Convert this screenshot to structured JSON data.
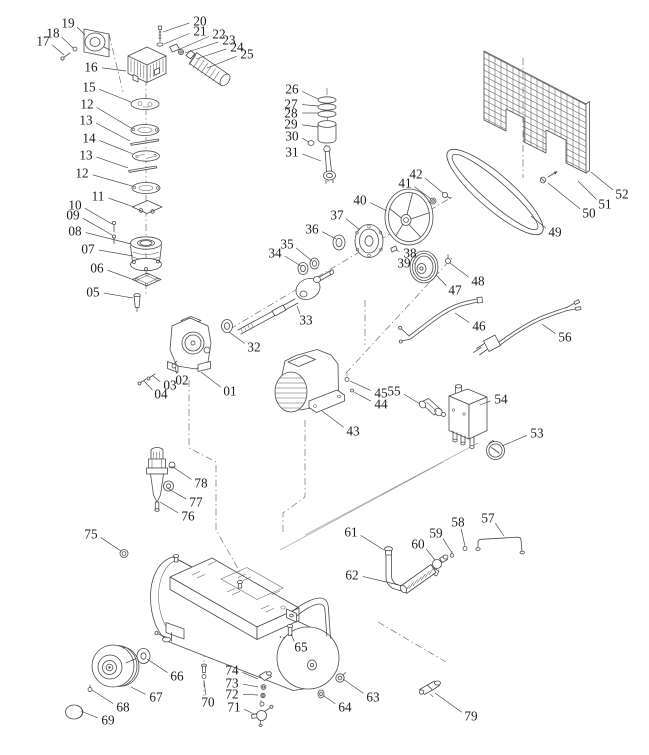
{
  "diagram": {
    "background": "#ffffff",
    "line_color": "#4a4a4a",
    "label_color": "#1b1b1b",
    "callouts": [
      {
        "label": "01",
        "x": 230,
        "y": 391,
        "tx": 201,
        "ty": 372
      },
      {
        "label": "02",
        "x": 182,
        "y": 380,
        "tx": 175,
        "ty": 367
      },
      {
        "label": "03",
        "x": 170,
        "y": 385,
        "tx": 153,
        "ty": 376
      },
      {
        "label": "04",
        "x": 161,
        "y": 394,
        "tx": 144,
        "ty": 381
      },
      {
        "label": "05",
        "x": 93,
        "y": 292,
        "tx": 133,
        "ty": 298
      },
      {
        "label": "06",
        "x": 97,
        "y": 268,
        "tx": 134,
        "ty": 280
      },
      {
        "label": "07",
        "x": 88,
        "y": 249,
        "tx": 133,
        "ty": 256
      },
      {
        "label": "08",
        "x": 75,
        "y": 231,
        "tx": 131,
        "ty": 244
      },
      {
        "label": "09",
        "x": 73,
        "y": 215,
        "tx": 112,
        "ty": 235
      },
      {
        "label": "10",
        "x": 75,
        "y": 205,
        "tx": 112,
        "ty": 224
      },
      {
        "label": "11",
        "x": 98,
        "y": 196,
        "tx": 134,
        "ty": 207
      },
      {
        "label": "12",
        "x": 87,
        "y": 104,
        "tx": 131,
        "ty": 128
      },
      {
        "label": "13",
        "x": 86,
        "y": 120,
        "tx": 130,
        "ty": 141
      },
      {
        "label": "14",
        "x": 89,
        "y": 138,
        "tx": 133,
        "ty": 154
      },
      {
        "label": "13",
        "x": 86,
        "y": 155,
        "tx": 128,
        "ty": 168
      },
      {
        "label": "12",
        "x": 82,
        "y": 173,
        "tx": 132,
        "ty": 186
      },
      {
        "label": "15",
        "x": 89,
        "y": 87,
        "tx": 131,
        "ty": 102
      },
      {
        "label": "16",
        "x": 91,
        "y": 67,
        "tx": 126,
        "ty": 71
      },
      {
        "label": "17",
        "x": 43,
        "y": 41,
        "tx": 64,
        "ty": 55
      },
      {
        "label": "18",
        "x": 53,
        "y": 33,
        "tx": 73,
        "ty": 48
      },
      {
        "label": "19",
        "x": 68,
        "y": 23,
        "tx": 85,
        "ty": 35
      },
      {
        "label": "20",
        "x": 200,
        "y": 21,
        "tx": 163,
        "ty": 32
      },
      {
        "label": "21",
        "x": 200,
        "y": 31,
        "tx": 164,
        "ty": 44
      },
      {
        "label": "22",
        "x": 219,
        "y": 34,
        "tx": 180,
        "ty": 49
      },
      {
        "label": "23",
        "x": 229,
        "y": 40,
        "tx": 185,
        "ty": 53
      },
      {
        "label": "24",
        "x": 237,
        "y": 47,
        "tx": 196,
        "ty": 59
      },
      {
        "label": "25",
        "x": 247,
        "y": 54,
        "tx": 207,
        "ty": 68
      },
      {
        "label": "26",
        "x": 292,
        "y": 89,
        "tx": 318,
        "ty": 99
      },
      {
        "label": "27",
        "x": 291,
        "y": 104,
        "tx": 318,
        "ty": 106
      },
      {
        "label": "28",
        "x": 291,
        "y": 113,
        "tx": 318,
        "ty": 113
      },
      {
        "label": "29",
        "x": 291,
        "y": 124,
        "tx": 318,
        "ty": 127
      },
      {
        "label": "30",
        "x": 292,
        "y": 136,
        "tx": 309,
        "ty": 142
      },
      {
        "label": "31",
        "x": 292,
        "y": 152,
        "tx": 321,
        "ty": 161
      },
      {
        "label": "32",
        "x": 254,
        "y": 347,
        "tx": 229,
        "ty": 332
      },
      {
        "label": "33",
        "x": 306,
        "y": 320,
        "tx": 297,
        "ty": 306
      },
      {
        "label": "34",
        "x": 275,
        "y": 253,
        "tx": 301,
        "ty": 266
      },
      {
        "label": "35",
        "x": 287,
        "y": 244,
        "tx": 312,
        "ty": 261
      },
      {
        "label": "36",
        "x": 312,
        "y": 229,
        "tx": 336,
        "ty": 239
      },
      {
        "label": "37",
        "x": 337,
        "y": 215,
        "tx": 360,
        "ty": 230
      },
      {
        "label": "38",
        "x": 410,
        "y": 253,
        "tx": 396,
        "ty": 250
      },
      {
        "label": "39",
        "x": 404,
        "y": 263,
        "tx": 414,
        "ty": 264
      },
      {
        "label": "40",
        "x": 360,
        "y": 200,
        "tx": 387,
        "ty": 211
      },
      {
        "label": "41",
        "x": 405,
        "y": 183,
        "tx": 431,
        "ty": 199
      },
      {
        "label": "42",
        "x": 416,
        "y": 174,
        "tx": 443,
        "ty": 193
      },
      {
        "label": "43",
        "x": 353,
        "y": 431,
        "tx": 322,
        "ty": 411
      },
      {
        "label": "44",
        "x": 381,
        "y": 404,
        "tx": 354,
        "ty": 392
      },
      {
        "label": "45",
        "x": 381,
        "y": 393,
        "tx": 350,
        "ty": 381
      },
      {
        "label": "46",
        "x": 479,
        "y": 326,
        "tx": 455,
        "ty": 313
      },
      {
        "label": "47",
        "x": 455,
        "y": 290,
        "tx": 436,
        "ty": 275
      },
      {
        "label": "48",
        "x": 478,
        "y": 281,
        "tx": 450,
        "ty": 263
      },
      {
        "label": "49",
        "x": 555,
        "y": 232,
        "tx": 531,
        "ty": 216
      },
      {
        "label": "50",
        "x": 589,
        "y": 213,
        "tx": 548,
        "ty": 183
      },
      {
        "label": "51",
        "x": 605,
        "y": 204,
        "tx": 578,
        "ty": 181
      },
      {
        "label": "52",
        "x": 622,
        "y": 194,
        "tx": 591,
        "ty": 172
      },
      {
        "label": "53",
        "x": 537,
        "y": 433,
        "tx": 502,
        "ty": 446
      },
      {
        "label": "54",
        "x": 501,
        "y": 399,
        "tx": 480,
        "ty": 405
      },
      {
        "label": "55",
        "x": 394,
        "y": 391,
        "tx": 420,
        "ty": 404
      },
      {
        "label": "56",
        "x": 565,
        "y": 337,
        "tx": 542,
        "ty": 324
      },
      {
        "label": "57",
        "x": 488,
        "y": 518,
        "tx": 504,
        "ty": 536
      },
      {
        "label": "58",
        "x": 458,
        "y": 522,
        "tx": 465,
        "ty": 546
      },
      {
        "label": "59",
        "x": 436,
        "y": 533,
        "tx": 452,
        "ty": 553
      },
      {
        "label": "60",
        "x": 418,
        "y": 544,
        "tx": 435,
        "ty": 560
      },
      {
        "label": "61",
        "x": 351,
        "y": 532,
        "tx": 384,
        "ty": 550
      },
      {
        "label": "62",
        "x": 352,
        "y": 575,
        "tx": 399,
        "ty": 585
      },
      {
        "label": "63",
        "x": 373,
        "y": 697,
        "tx": 343,
        "ty": 679
      },
      {
        "label": "64",
        "x": 345,
        "y": 707,
        "tx": 324,
        "ty": 696
      },
      {
        "label": "65",
        "x": 301,
        "y": 647,
        "tx": 291,
        "ty": 634
      },
      {
        "label": "66",
        "x": 177,
        "y": 676,
        "tx": 147,
        "ty": 659
      },
      {
        "label": "67",
        "x": 156,
        "y": 697,
        "tx": 131,
        "ty": 687
      },
      {
        "label": "68",
        "x": 123,
        "y": 707,
        "tx": 92,
        "ty": 690
      },
      {
        "label": "69",
        "x": 108,
        "y": 720,
        "tx": 81,
        "ty": 711
      },
      {
        "label": "70",
        "x": 208,
        "y": 702,
        "tx": 204,
        "ty": 681
      },
      {
        "label": "71",
        "x": 234,
        "y": 707,
        "tx": 254,
        "ty": 714
      },
      {
        "label": "72",
        "x": 232,
        "y": 694,
        "tx": 258,
        "ty": 695
      },
      {
        "label": "73",
        "x": 232,
        "y": 683,
        "tx": 258,
        "ty": 687
      },
      {
        "label": "74",
        "x": 232,
        "y": 670,
        "tx": 258,
        "ty": 679
      },
      {
        "label": "75",
        "x": 91,
        "y": 534,
        "tx": 121,
        "ty": 551
      },
      {
        "label": "76",
        "x": 188,
        "y": 516,
        "tx": 160,
        "ty": 502
      },
      {
        "label": "77",
        "x": 196,
        "y": 502,
        "tx": 167,
        "ty": 488
      },
      {
        "label": "78",
        "x": 201,
        "y": 483,
        "tx": 173,
        "ty": 467
      },
      {
        "label": "79",
        "x": 471,
        "y": 716,
        "tx": 435,
        "ty": 693
      }
    ]
  }
}
